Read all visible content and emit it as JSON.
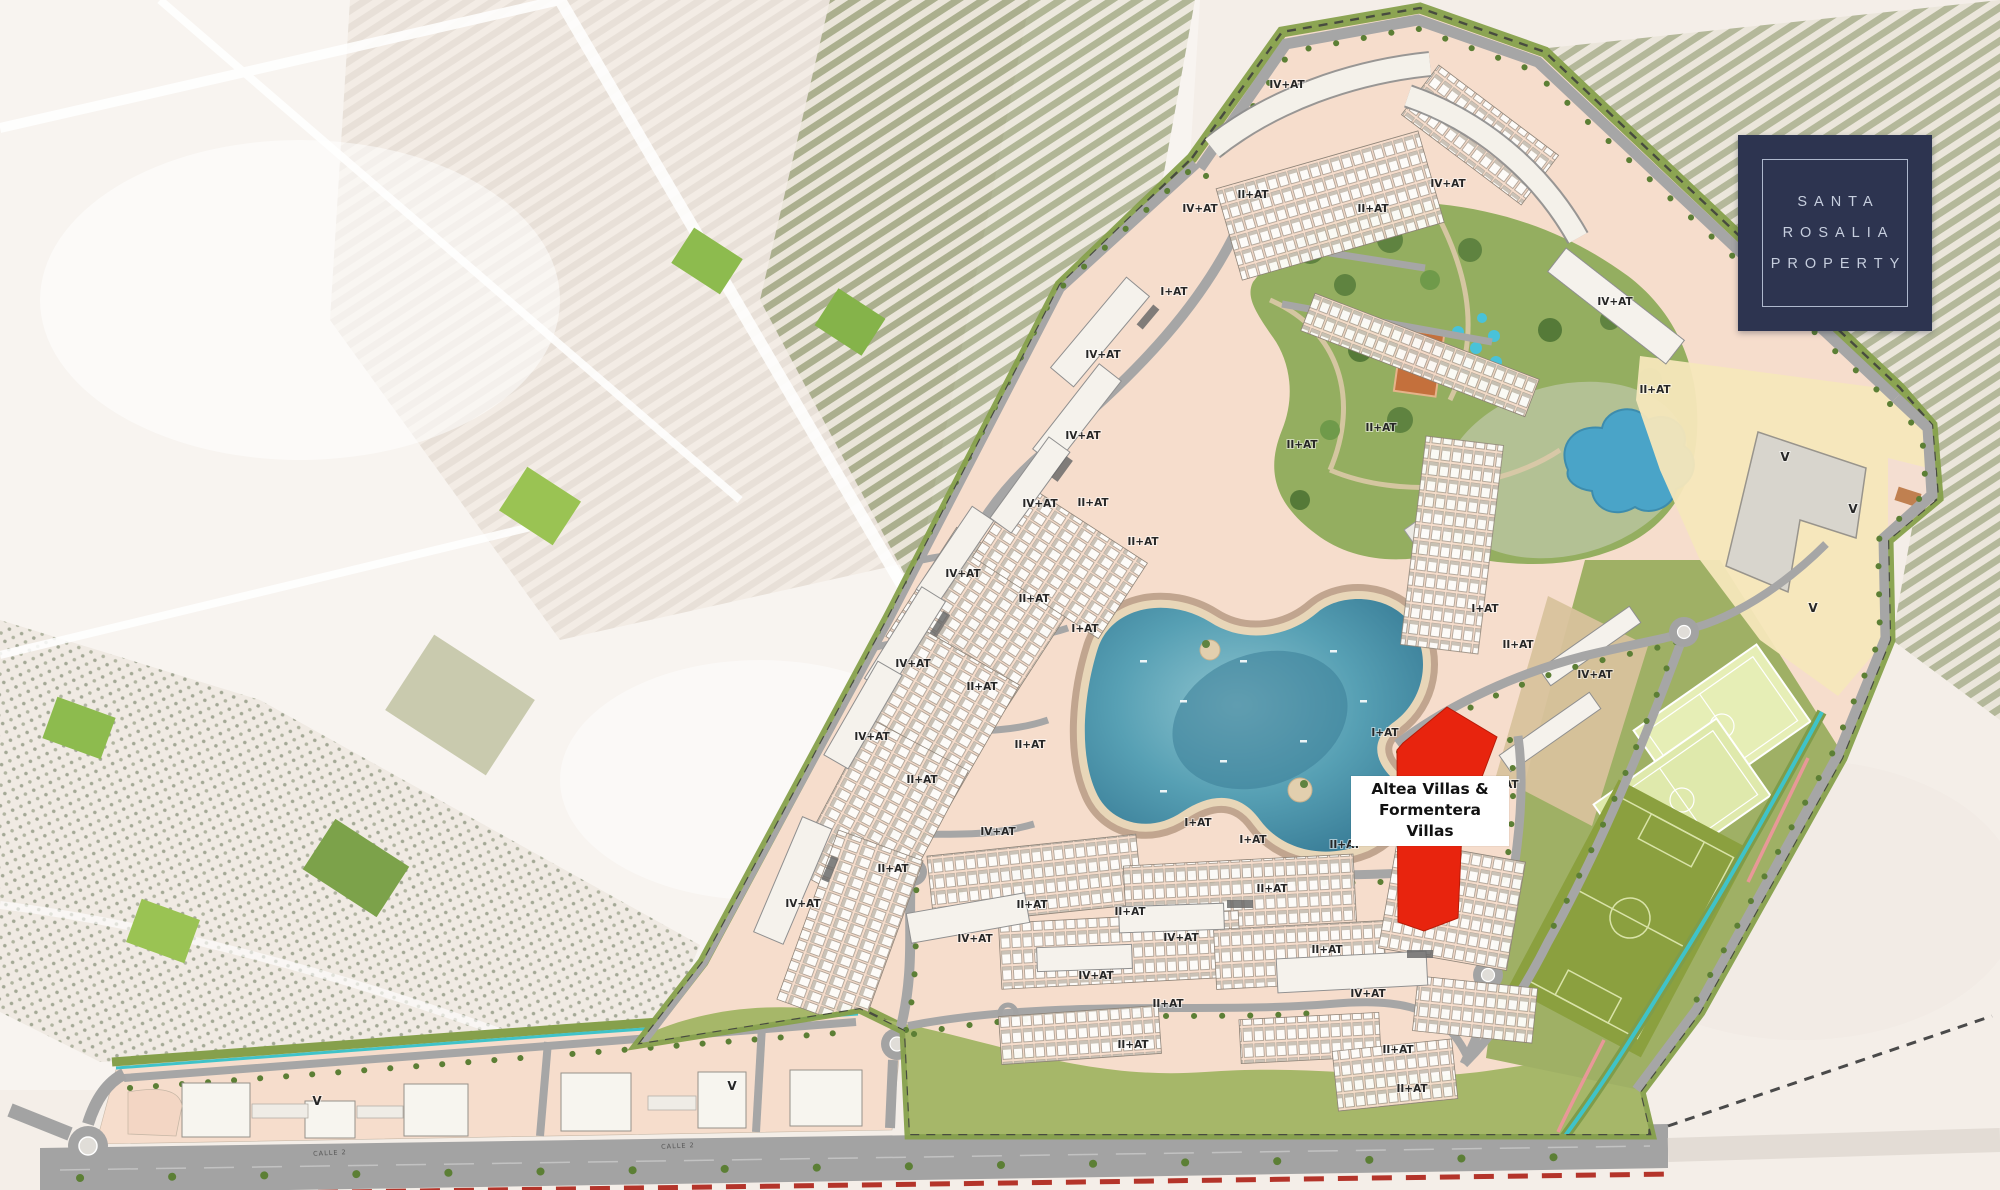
{
  "logo": {
    "line1": "SANTA",
    "line2": "ROSALIA",
    "line3": "PROPERTY"
  },
  "highlight": {
    "line1": "Altea  Villas &",
    "line2": "Formentera Villas"
  },
  "map": {
    "colors": {
      "highlight_red": "#e8240e",
      "callout_bg": "#ffffff",
      "callout_text": "#111111",
      "logo_bg": "#2d3450",
      "logo_text": "#c6cede",
      "site_pink": "#f6ddcc",
      "park_green": "#94ae60",
      "meadow_green": "#a6b769",
      "lagoon_deep": "#3a7e98",
      "lagoon_mid": "#57a0b4",
      "road_gray": "#a6a6a6",
      "boundary_olive": "#86a04b",
      "canal_teal": "#3fc3c9",
      "pitch_light": "#e6eeb6",
      "grass_field": "#8ba03f",
      "sand_yellow": "#f5e7bb",
      "tan_plot": "#d8c29c",
      "red_dash": "#b4342a"
    },
    "plot_labels": [
      {
        "t": "IV+AT",
        "x": 1287,
        "y": 88
      },
      {
        "t": "IV+AT",
        "x": 1448,
        "y": 187
      },
      {
        "t": "IV+AT",
        "x": 1200,
        "y": 212
      },
      {
        "t": "IV+AT",
        "x": 1615,
        "y": 305
      },
      {
        "t": "IV+AT",
        "x": 1103,
        "y": 358
      },
      {
        "t": "IV+AT",
        "x": 1083,
        "y": 439
      },
      {
        "t": "IV+AT",
        "x": 1040,
        "y": 507
      },
      {
        "t": "IV+AT",
        "x": 963,
        "y": 577
      },
      {
        "t": "IV+AT",
        "x": 913,
        "y": 667
      },
      {
        "t": "IV+AT",
        "x": 872,
        "y": 740
      },
      {
        "t": "IV+AT",
        "x": 803,
        "y": 907
      },
      {
        "t": "IV+AT",
        "x": 998,
        "y": 835
      },
      {
        "t": "IV+AT",
        "x": 975,
        "y": 942
      },
      {
        "t": "IV+AT",
        "x": 1181,
        "y": 941
      },
      {
        "t": "IV+AT",
        "x": 1096,
        "y": 979
      },
      {
        "t": "IV+AT",
        "x": 1368,
        "y": 997
      },
      {
        "t": "IV+AT",
        "x": 1595,
        "y": 678
      },
      {
        "t": "II+AT",
        "x": 1253,
        "y": 198
      },
      {
        "t": "II+AT",
        "x": 1373,
        "y": 212
      },
      {
        "t": "II+AT",
        "x": 1655,
        "y": 393
      },
      {
        "t": "II+AT",
        "x": 1143,
        "y": 545
      },
      {
        "t": "II+AT",
        "x": 1093,
        "y": 506
      },
      {
        "t": "II+AT",
        "x": 1034,
        "y": 602
      },
      {
        "t": "II+AT",
        "x": 982,
        "y": 690
      },
      {
        "t": "II+AT",
        "x": 1030,
        "y": 748
      },
      {
        "t": "II+AT",
        "x": 922,
        "y": 783
      },
      {
        "t": "II+AT",
        "x": 893,
        "y": 872
      },
      {
        "t": "II+AT",
        "x": 1302,
        "y": 448
      },
      {
        "t": "II+AT",
        "x": 1381,
        "y": 431
      },
      {
        "t": "II+AT",
        "x": 1518,
        "y": 648
      },
      {
        "t": "II+AT",
        "x": 1345,
        "y": 848
      },
      {
        "t": "II+AT",
        "x": 1272,
        "y": 892
      },
      {
        "t": "II+AT",
        "x": 1130,
        "y": 915
      },
      {
        "t": "II+AT",
        "x": 1032,
        "y": 908
      },
      {
        "t": "II+AT",
        "x": 1327,
        "y": 953
      },
      {
        "t": "II+AT",
        "x": 1168,
        "y": 1007
      },
      {
        "t": "II+AT",
        "x": 1133,
        "y": 1048
      },
      {
        "t": "II+AT",
        "x": 1398,
        "y": 1053
      },
      {
        "t": "II+AT",
        "x": 1412,
        "y": 1092
      },
      {
        "t": "I+AT",
        "x": 1174,
        "y": 295
      },
      {
        "t": "I+AT",
        "x": 1085,
        "y": 632
      },
      {
        "t": "I+AT",
        "x": 1385,
        "y": 736
      },
      {
        "t": "I+AT",
        "x": 1485,
        "y": 612
      },
      {
        "t": "I+AT",
        "x": 1198,
        "y": 826
      },
      {
        "t": "I+AT",
        "x": 1253,
        "y": 843
      },
      {
        "t": "I+AT",
        "x": 1505,
        "y": 788
      },
      {
        "t": "V",
        "x": 317,
        "y": 1105
      },
      {
        "t": "V",
        "x": 732,
        "y": 1090
      },
      {
        "t": "V",
        "x": 1785,
        "y": 461
      },
      {
        "t": "V",
        "x": 1853,
        "y": 513
      },
      {
        "t": "V",
        "x": 1813,
        "y": 612
      }
    ],
    "street_labels": [
      {
        "t": "CALLE 2",
        "x": 330,
        "y": 1155,
        "r": -3
      },
      {
        "t": "CALLE 2",
        "x": 678,
        "y": 1148,
        "r": -3
      }
    ]
  }
}
